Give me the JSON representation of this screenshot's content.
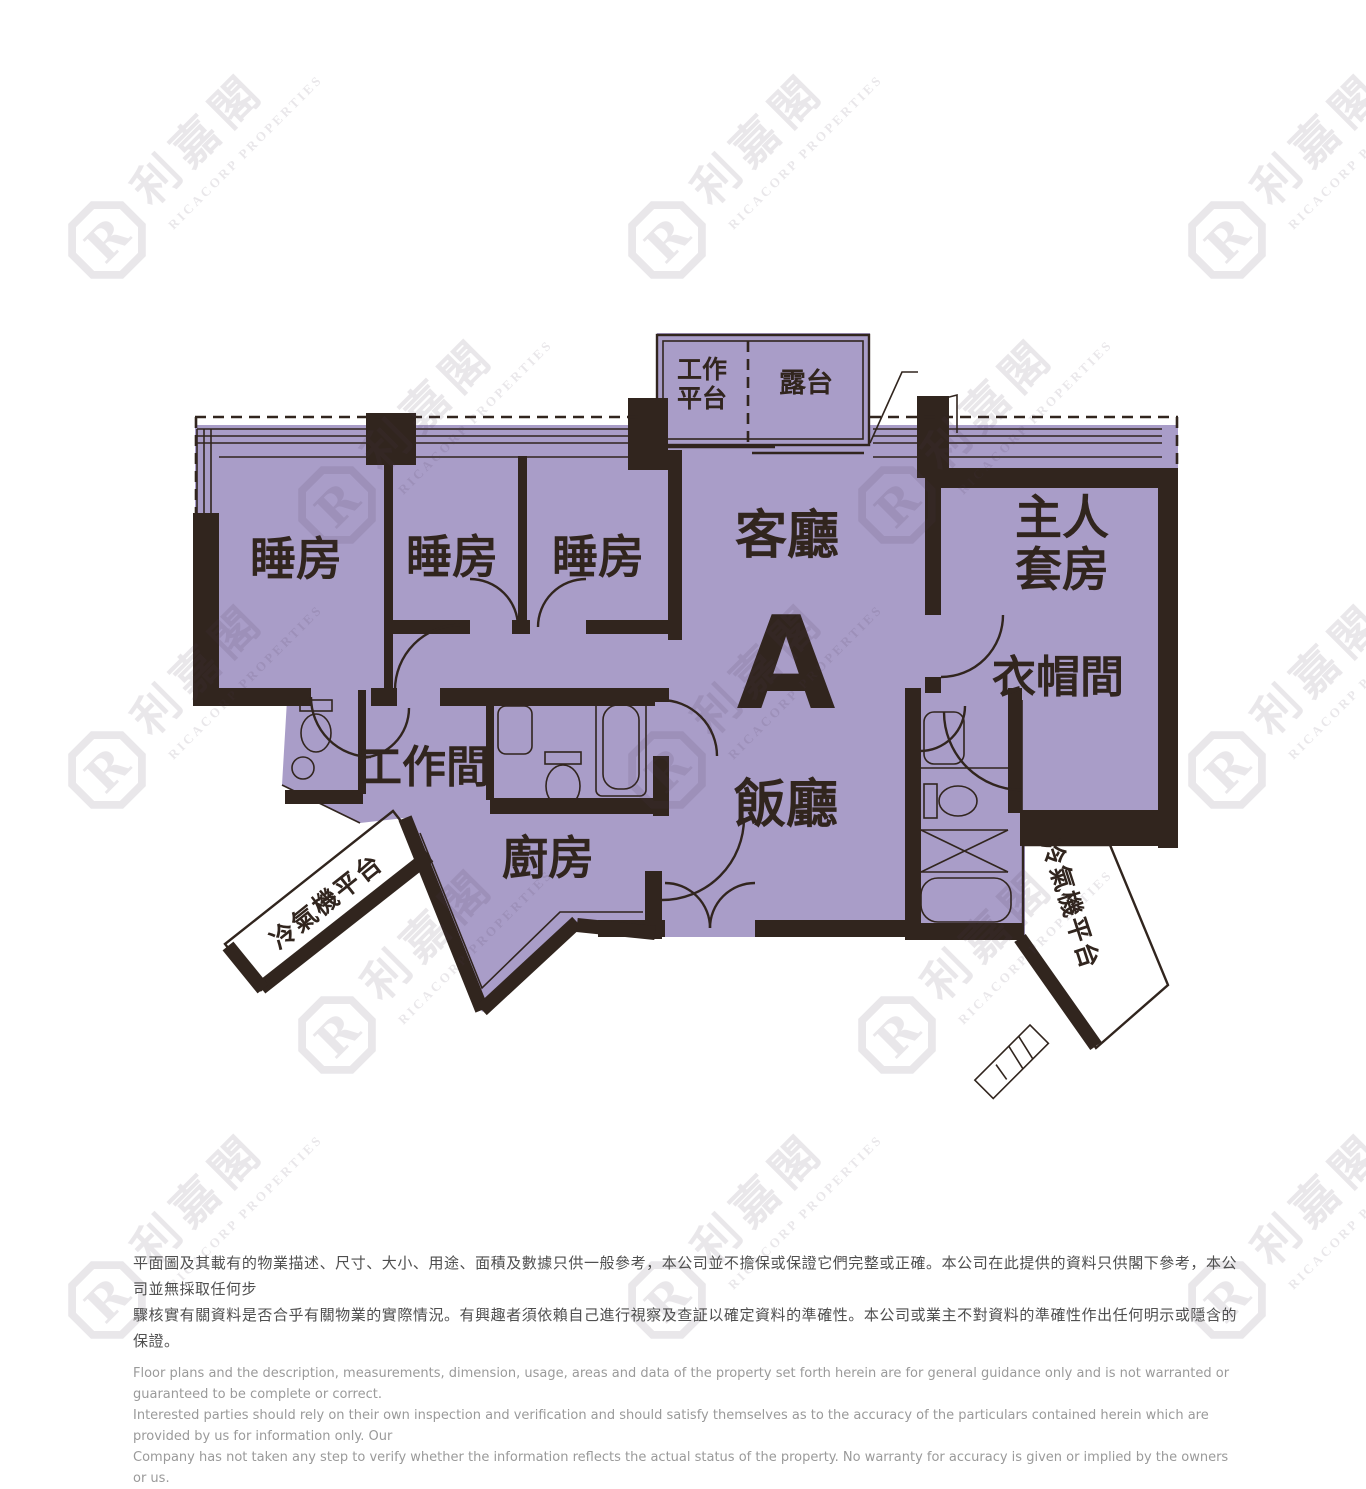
{
  "floorplan": {
    "unit_letter": "A",
    "rooms": {
      "bedroom1": "睡房",
      "bedroom2": "睡房",
      "bedroom3": "睡房",
      "living": "客廳",
      "dining": "飯廳",
      "master_line1": "主人",
      "master_line2": "套房",
      "closet": "衣帽間",
      "workroom": "工作間",
      "kitchen": "廚房",
      "balcony": "露台",
      "utility_line1": "工作",
      "utility_line2": "平台",
      "ac_platform_left": "冷氣機平台",
      "ac_platform_right": "冷氣機平台"
    },
    "colors": {
      "floor_fill": "#a99dc8",
      "wall": "#31251e",
      "outside": "#ffffff"
    }
  },
  "watermark": {
    "chinese": "利嘉閣",
    "english": "RICACORP PROPERTIES",
    "logo_letter": "R"
  },
  "disclaimer": {
    "chinese_line1": "平面圖及其載有的物業描述、尺寸、大小、用途、面積及數據只供一般參考，本公司並不擔保或保證它們完整或正確。本公司在此提供的資料只供閣下參考，本公司並無採取任何步",
    "chinese_line2": "驟核實有關資料是否合乎有關物業的實際情況。有興趣者須依賴自己進行視察及查証以確定資料的準確性。本公司或業主不對資料的準確性作出任何明示或隱含的保證。",
    "english_line1": "Floor plans and the description, measurements, dimension, usage, areas and data of the property set forth herein are for general guidance only and is not warranted or guaranteed to be complete or correct.",
    "english_line2": "Interested parties should rely on their own inspection and verification and should satisfy themselves as to the accuracy of the particulars contained herein which are provided by us for information only.  Our",
    "english_line3": "Company has not taken any step to verify whether the information reflects the actual status of the property.  No warranty for accuracy is given or implied by the owners or us."
  }
}
